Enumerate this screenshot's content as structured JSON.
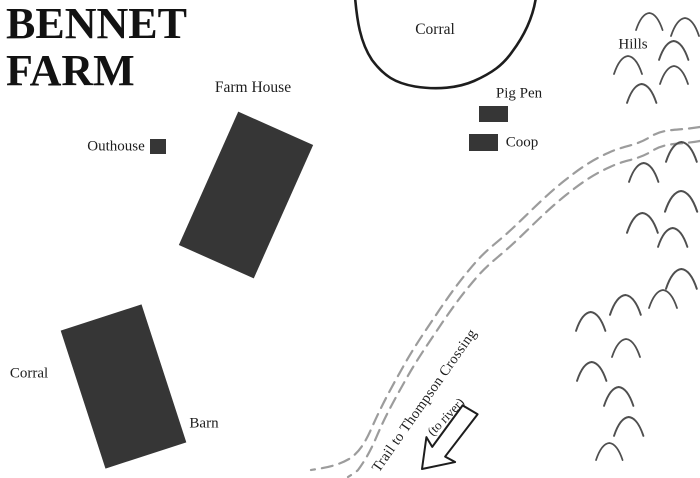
{
  "map": {
    "title_lines": [
      "BENNET",
      "FARM"
    ],
    "features": {
      "corral_top": "Corral",
      "hills": "Hills",
      "farm_house": "Farm House",
      "pig_pen": "Pig Pen",
      "outhouse": "Outhouse",
      "coop": "Coop",
      "corral_bottom": "Corral",
      "barn": "Barn"
    },
    "trail": {
      "label": "Trail to Thompson Crossing",
      "destination_note": "(to river)",
      "style": "double-dashed-line",
      "arrow_direction": "southwest"
    },
    "colors": {
      "background": "#ffffff",
      "building_fill": "#363636",
      "outline": "#1d1d1d",
      "trail": "#9c9c9c",
      "hill": "#4f4f4f"
    },
    "hills": {
      "count": 20,
      "symbol": "arc",
      "positions": [
        [
          636,
          13,
          0.95
        ],
        [
          671,
          18,
          1.0
        ],
        [
          659,
          41,
          1.05
        ],
        [
          614,
          56,
          1.0
        ],
        [
          660,
          66,
          1.0
        ],
        [
          627,
          84,
          1.05
        ],
        [
          666,
          142,
          1.1
        ],
        [
          629,
          163,
          1.05
        ],
        [
          665,
          191,
          1.15
        ],
        [
          627,
          213,
          1.1
        ],
        [
          658,
          228,
          1.05
        ],
        [
          666,
          269,
          1.1
        ],
        [
          649,
          290,
          1.0
        ],
        [
          610,
          295,
          1.1
        ],
        [
          576,
          312,
          1.05
        ],
        [
          612,
          339,
          1.0
        ],
        [
          577,
          362,
          1.05
        ],
        [
          604,
          387,
          1.05
        ],
        [
          614,
          417,
          1.05
        ],
        [
          596,
          443,
          0.95
        ]
      ]
    }
  }
}
